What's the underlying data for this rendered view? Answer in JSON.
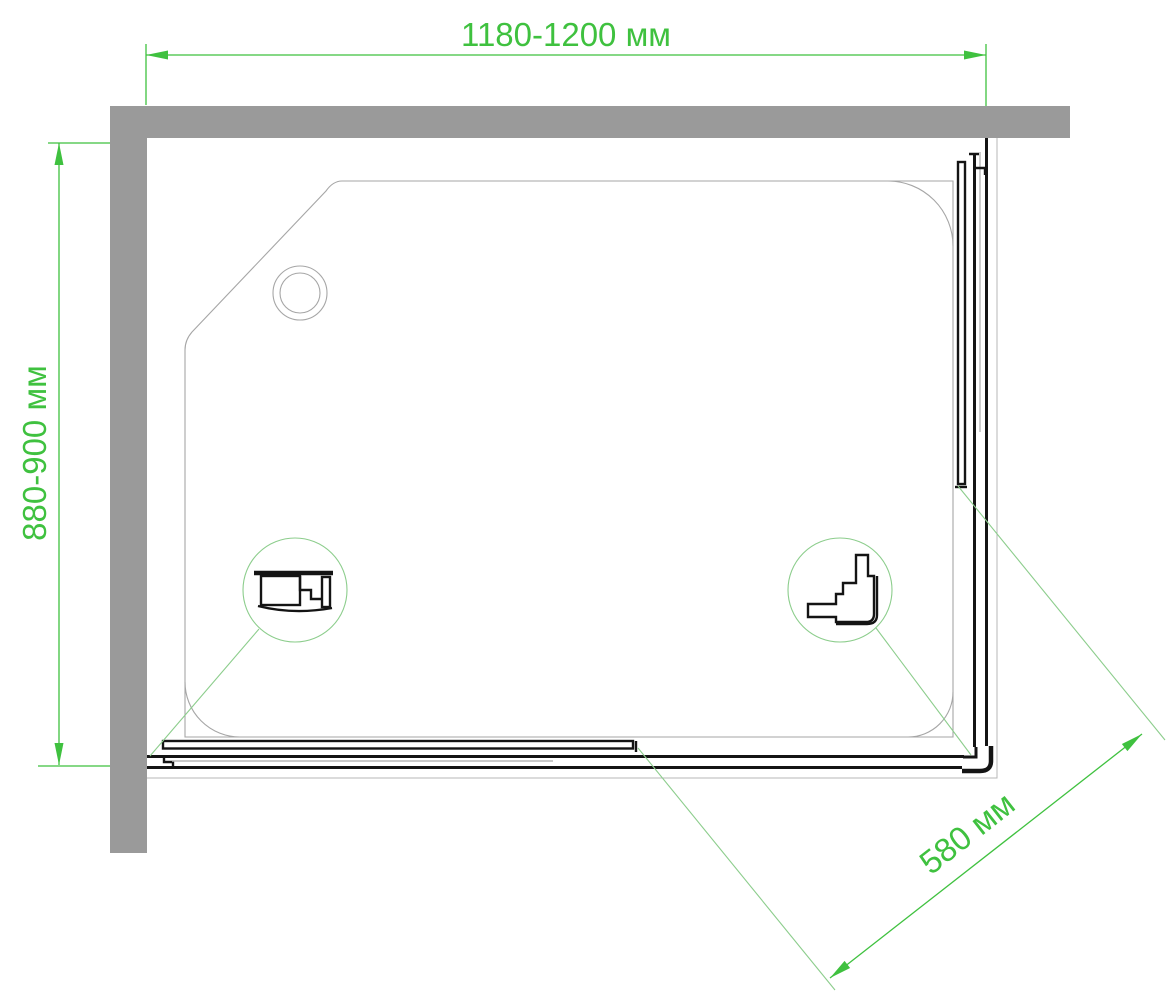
{
  "drawing": {
    "dimensions": {
      "width": {
        "label": "1180-1200 мм"
      },
      "depth": {
        "label": "880-900 мм"
      },
      "entry": {
        "label": "580 мм"
      }
    },
    "colors": {
      "dimension_green": "#3fc13f",
      "callout_green": "#8ccd8c",
      "wall_gray": "#9a9a9a",
      "tray_outline_gray": "#a6a6a6",
      "profile_black": "#141414",
      "background": "#ffffff"
    }
  }
}
